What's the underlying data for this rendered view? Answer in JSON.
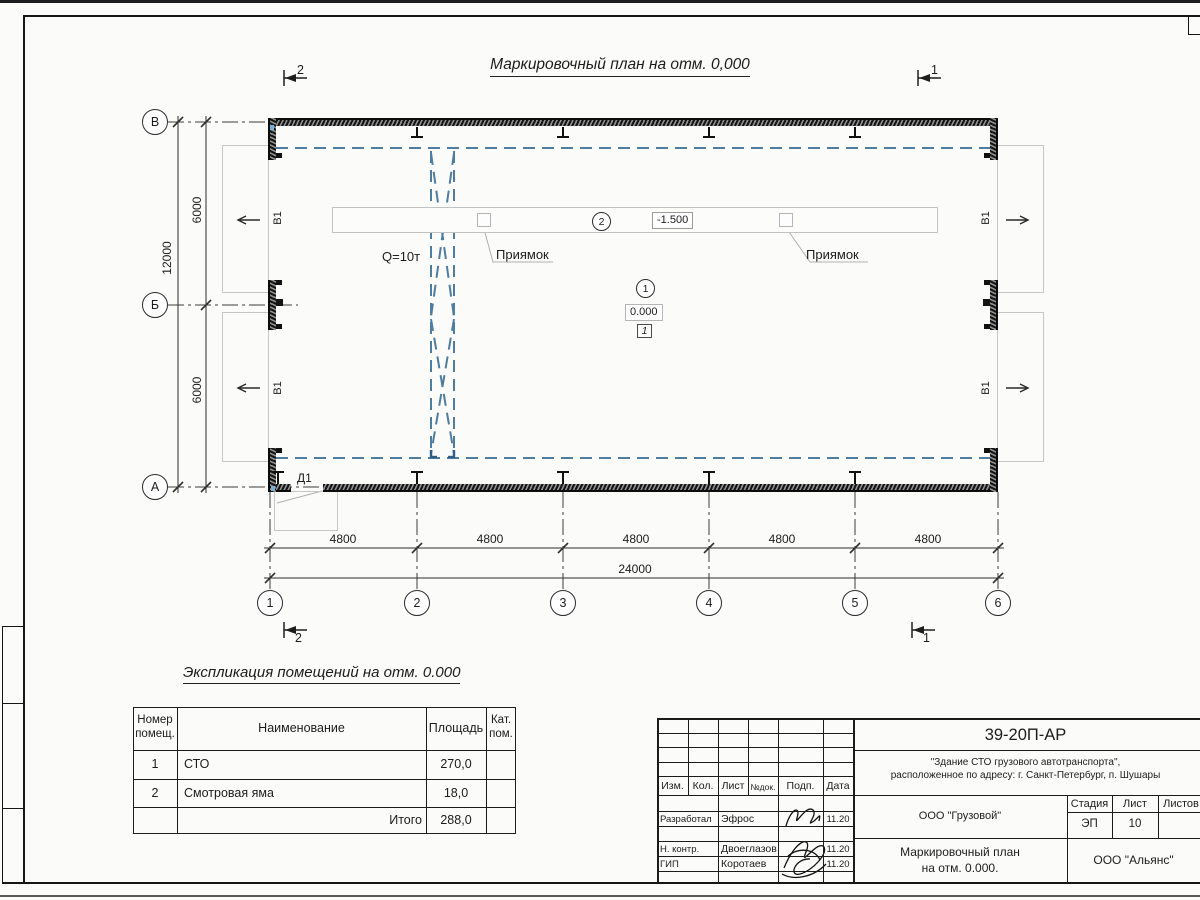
{
  "page": {
    "title": "Маркировочный план на отм. 0,000"
  },
  "plan": {
    "axes_rows": [
      "В",
      "Б",
      "А"
    ],
    "axes_cols": [
      "1",
      "2",
      "3",
      "4",
      "5",
      "6"
    ],
    "dims": {
      "bay": "4800",
      "total": "24000",
      "half": "6000",
      "full": "12000"
    },
    "labels": {
      "crane": "Q=10т",
      "pit": "Приямок",
      "pit_level": "-1.500",
      "floor_level": "0.000",
      "room_mark": "1",
      "gate": "В1",
      "door": "Д1"
    },
    "callouts": {
      "floor": "1",
      "pit": "2"
    },
    "sections": {
      "s1": "1",
      "s2": "2"
    }
  },
  "explication": {
    "title": "Экспликация помещений на отм. 0.000",
    "headers": {
      "num": "Номер помещ.",
      "name": "Наименование",
      "area": "Площадь",
      "cat": "Кат. пом."
    },
    "rows": [
      {
        "num": "1",
        "name": "СТО",
        "area": "270,0",
        "cat": ""
      },
      {
        "num": "2",
        "name": "Смотровая яма",
        "area": "18,0",
        "cat": ""
      }
    ],
    "total": {
      "label": "Итого",
      "area": "288,0"
    }
  },
  "titleblock": {
    "code": "39-20П-АР",
    "project_line1": "\"Здание СТО грузового автотранспорта\",",
    "project_line2": "расположенное по адресу: г. Санкт-Петербург, п. Шушары",
    "cols": {
      "izm": "Изм.",
      "kol": "Кол.",
      "list": "Лист",
      "doc": "№док.",
      "podp": "Подп.",
      "data": "Дата"
    },
    "roles": [
      {
        "role": "Разработал",
        "name": "Эфрос",
        "date": "11.20"
      },
      {
        "role": "Н. контр.",
        "name": "Двоеглазов",
        "date": "11.20"
      },
      {
        "role": "ГИП",
        "name": "Коротаев",
        "date": "11.20"
      }
    ],
    "org": "ООО \"Грузовой\"",
    "stage_label": "Стадия",
    "sheet_label": "Лист",
    "sheets_label": "Листов",
    "stage": "ЭП",
    "sheet_no": "10",
    "sheets": "",
    "sheet_title_line1": "Маркировочный план",
    "sheet_title_line2": "на отм. 0.000.",
    "company": "ООО \"Альянс\""
  }
}
